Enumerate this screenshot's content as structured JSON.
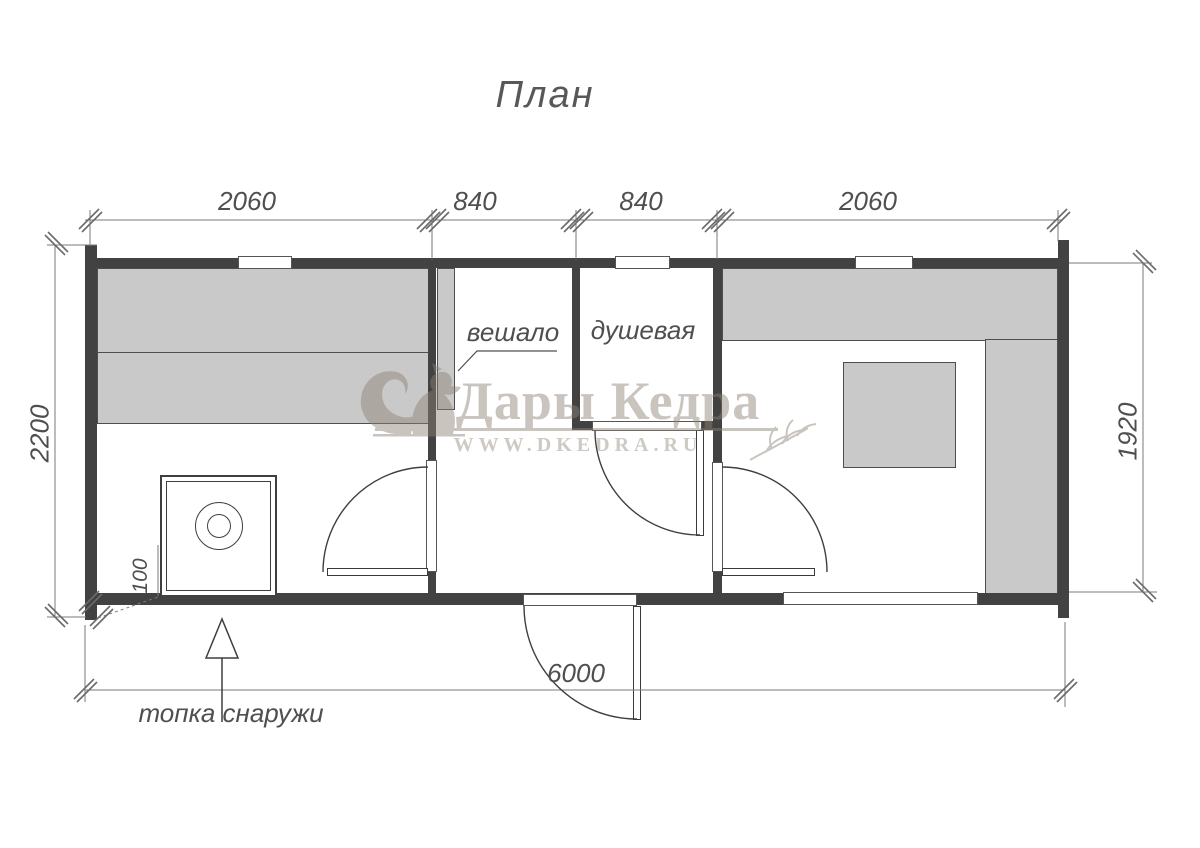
{
  "title": "План",
  "dimensions": {
    "top": [
      "2060",
      "840",
      "840",
      "2060"
    ],
    "bottom": "6000",
    "left": "2200",
    "right": "1920",
    "stove_offset": "100"
  },
  "rooms": {
    "hanger_label": "вешало",
    "shower_label": "душевая"
  },
  "annotations": {
    "furnace_note": "топка снаружи"
  },
  "watermark": {
    "brand": "Дары Кедра",
    "site": "WWW.DKEDRA.RU",
    "icons": [
      "squirrel-icon",
      "wheat-icon"
    ]
  },
  "colors": {
    "wall": "#424242",
    "bench": "#c9c9c9",
    "line": "#6e6e6e",
    "watermark": "#8d8175"
  }
}
